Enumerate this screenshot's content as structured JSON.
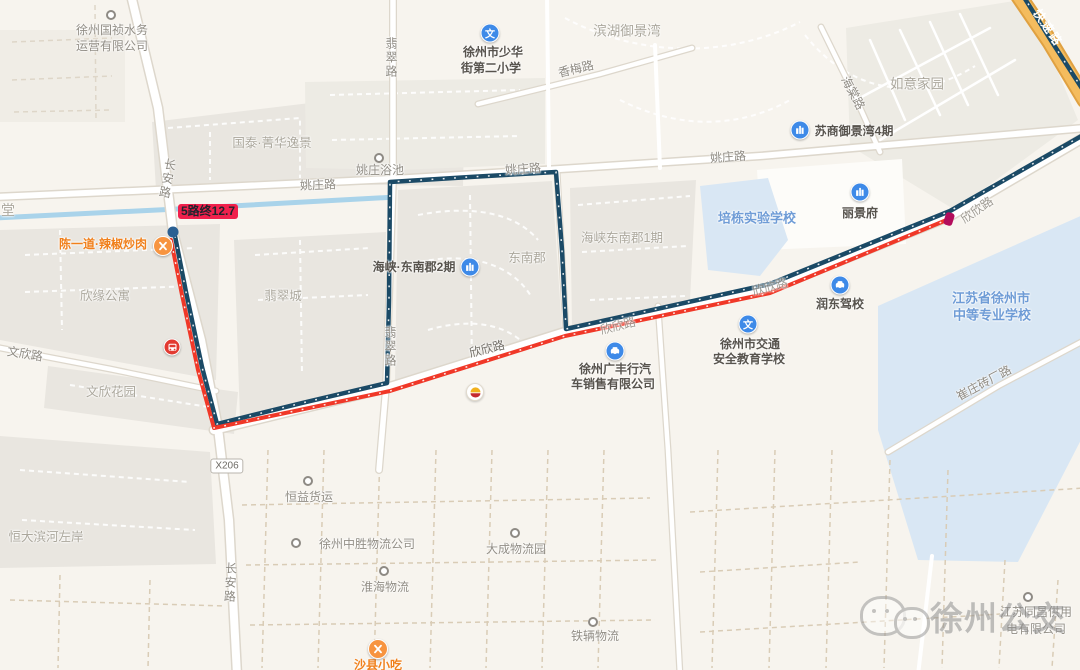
{
  "badge": {
    "route_end": "5路终12.7",
    "x206": "X206"
  },
  "watermark": {
    "brand": "徐州公交"
  },
  "roads": {
    "changan_top": "长安路",
    "changan_bottom": "长安路",
    "feicui_top": "翡翠路",
    "feicui_mid": "翡翠路",
    "haitang": "海棠路",
    "yaozhuang_w": "姚庄路",
    "yaozhuang_m": "姚庄路",
    "yaozhuang_e": "姚庄路",
    "xiangmei": "香梅路",
    "wenxinlu": "文欣路",
    "xinxin_a": "欣欣路",
    "xinxin_b": "欣欣路",
    "xinxin_c": "欣欣路",
    "xinxin_d": "欣欣路",
    "cuizhuang": "崔庄砖厂路",
    "expressway": "快速路"
  },
  "areas": {
    "tang": "堂",
    "guotai": "国泰·菁华逸景",
    "binhu": "滨湖御景湾",
    "ruyijiayuan": "如意家园",
    "xinyuan": "欣缘公寓",
    "feicuicheng": "翡翠城",
    "dongnanjun": "东南郡",
    "haixia1": "海峡东南郡1期",
    "hengda": "恒大滨河左岸",
    "wenxinhuayuan": "文欣花园"
  },
  "schools": {
    "peidong": "培栋实验学校",
    "zhongzhuan_1": "江苏省徐州市",
    "zhongzhuan_2": "中等专业学校"
  },
  "pois": {
    "guozhen_1": "徐州国祯水务",
    "guozhen_2": "运营有限公司",
    "shaohua_1": "徐州市少华",
    "shaohua_2": "街第二小学",
    "yaozhuang_bath": "姚庄浴池",
    "sushang": "苏商御景湾4期",
    "lijingfu": "丽景府",
    "haixia2": "海峡·东南郡2期",
    "rundong": "润东驾校",
    "jiaotong_1": "徐州市交通",
    "jiaotong_2": "安全教育学校",
    "guangfeng_1": "徐州广丰行汽",
    "guangfeng_2": "车销售有限公司",
    "chenyidao": "陈一道·辣椒炒肉",
    "shaxian": "沙县小吃",
    "hengyi": "恒益货运",
    "zhongsheng": "徐州中胜物流公司",
    "dacheng": "大成物流园",
    "huaihai": "淮海物流",
    "tieliang": "铁辆物流",
    "tongchang_1": "江苏同昌供用",
    "tongchang_2": "电有限公司"
  },
  "icons": {
    "school_glyph": "文"
  },
  "colors": {
    "route_navy": "#1b4a66",
    "route_red": "#f03828",
    "river": "#a9d3ea",
    "campus": "#d9e7f4",
    "expressway": "#f4bc5e",
    "poi_blue": "#3e8ae8",
    "poi_orange": "#f79440",
    "stop_badge": "#f0204c",
    "end_marker": "#b30d5c"
  }
}
